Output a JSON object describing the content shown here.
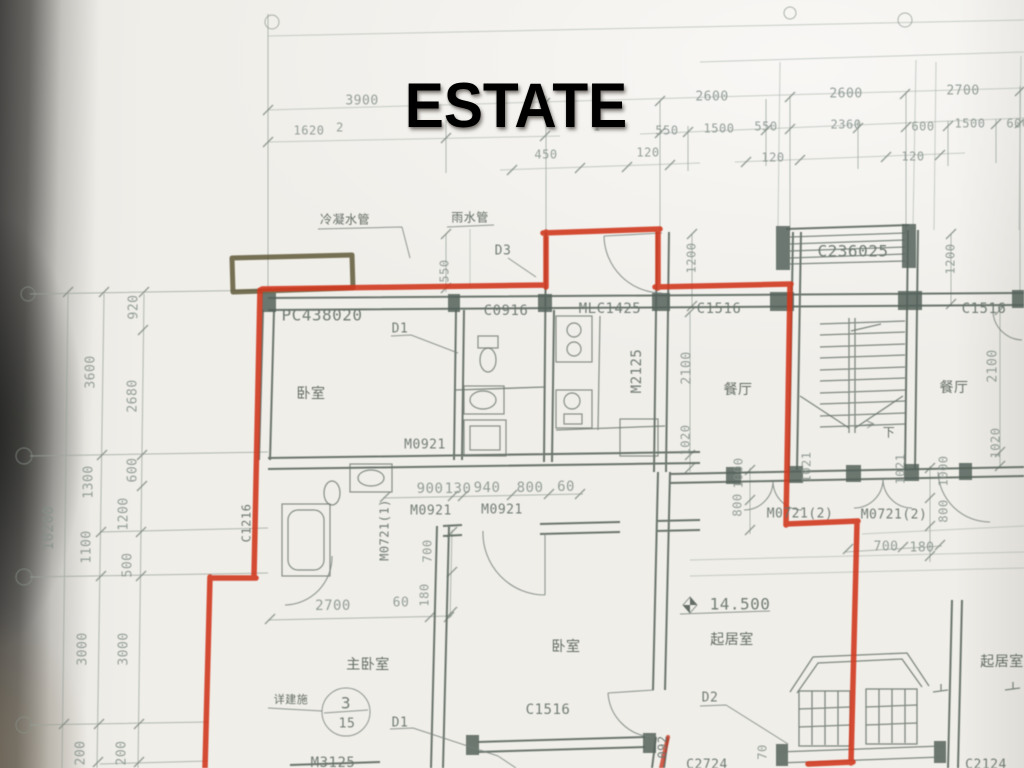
{
  "slide": {
    "title": "ESTATE",
    "title_color": "#ffffff"
  },
  "palette": {
    "paper": "#f0eee9",
    "dim_line": "#9aa49c",
    "dim_text": "#84908a",
    "cad_text": "#68736c",
    "wall": "#5c685f",
    "red_marker": "#d0381f",
    "olive_marker": "#56502e"
  },
  "plan": {
    "type": "architectural-floor-plan-photo",
    "rooms": [
      "卧室",
      "主卧室",
      "餐厅",
      "起居室"
    ],
    "elevation_marker": "14.500",
    "detail_ref": {
      "numerator": "3",
      "denominator": "15",
      "note": "详建施"
    },
    "labels": [
      {
        "n": "dim-3900",
        "t": "3900",
        "x": 362,
        "y": 101,
        "s": 13,
        "k": "dim"
      },
      {
        "n": "dim-2600-a",
        "t": "2600",
        "x": 712,
        "y": 97,
        "s": 13,
        "k": "dim"
      },
      {
        "n": "dim-2600-b",
        "t": "2600",
        "x": 846,
        "y": 94,
        "s": 13,
        "k": "dim"
      },
      {
        "n": "dim-2700-top",
        "t": "2700",
        "x": 963,
        "y": 91,
        "s": 13,
        "k": "dim"
      },
      {
        "n": "dim-1620",
        "t": "1620",
        "x": 309,
        "y": 131,
        "s": 12,
        "k": "dim"
      },
      {
        "n": "dim-partial-2",
        "t": "2",
        "x": 340,
        "y": 128,
        "s": 12,
        "k": "dim"
      },
      {
        "n": "dim-partial-1",
        "t": "1",
        "x": 597,
        "y": 127,
        "s": 12,
        "k": "dim"
      },
      {
        "n": "dim-550-a",
        "t": "550",
        "x": 667,
        "y": 131,
        "s": 12,
        "k": "dim"
      },
      {
        "n": "dim-1500-a",
        "t": "1500",
        "x": 719,
        "y": 129,
        "s": 12,
        "k": "dim"
      },
      {
        "n": "dim-550-b",
        "t": "550",
        "x": 766,
        "y": 127,
        "s": 12,
        "k": "dim"
      },
      {
        "n": "dim-2360",
        "t": "2360",
        "x": 846,
        "y": 125,
        "s": 12,
        "k": "dim"
      },
      {
        "n": "dim-600-a",
        "t": "600",
        "x": 923,
        "y": 127,
        "s": 12,
        "k": "dim"
      },
      {
        "n": "dim-1500-b",
        "t": "1500",
        "x": 970,
        "y": 124,
        "s": 12,
        "k": "dim"
      },
      {
        "n": "dim-600-b",
        "t": "600",
        "x": 1018,
        "y": 124,
        "s": 12,
        "k": "dim"
      },
      {
        "n": "dim-450",
        "t": "450",
        "x": 546,
        "y": 155,
        "s": 12,
        "k": "dim"
      },
      {
        "n": "dim-120-a",
        "t": "120",
        "x": 648,
        "y": 153,
        "s": 12,
        "k": "dim"
      },
      {
        "n": "dim-120-b",
        "t": "120",
        "x": 773,
        "y": 158,
        "s": 12,
        "k": "dim"
      },
      {
        "n": "dim-120-c",
        "t": "120",
        "x": 913,
        "y": 157,
        "s": 12,
        "k": "dim"
      },
      {
        "n": "dim-920",
        "t": "920",
        "x": 134,
        "y": 307,
        "r": -90,
        "s": 13,
        "k": "dim"
      },
      {
        "n": "dim-3600",
        "t": "3600",
        "x": 91,
        "y": 372,
        "r": -90,
        "s": 13,
        "k": "dim"
      },
      {
        "n": "dim-2680",
        "t": "2680",
        "x": 133,
        "y": 396,
        "r": -90,
        "s": 13,
        "k": "dim"
      },
      {
        "n": "dim-600-left",
        "t": "600",
        "x": 133,
        "y": 470,
        "r": -90,
        "s": 13,
        "k": "dim"
      },
      {
        "n": "dim-1300",
        "t": "1300",
        "x": 89,
        "y": 482,
        "r": -90,
        "s": 13,
        "k": "dim"
      },
      {
        "n": "dim-1200-left",
        "t": "1200",
        "x": 124,
        "y": 514,
        "r": -90,
        "s": 13,
        "k": "dim"
      },
      {
        "n": "dim-10200",
        "t": "10200",
        "x": 49,
        "y": 528,
        "r": -90,
        "s": 14,
        "k": "dim"
      },
      {
        "n": "dim-1100",
        "t": "1100",
        "x": 87,
        "y": 547,
        "r": -90,
        "s": 13,
        "k": "dim"
      },
      {
        "n": "dim-500-left",
        "t": "500",
        "x": 128,
        "y": 565,
        "r": -90,
        "s": 13,
        "k": "dim"
      },
      {
        "n": "dim-3000-a",
        "t": "3000",
        "x": 83,
        "y": 649,
        "r": -90,
        "s": 13,
        "k": "dim"
      },
      {
        "n": "dim-3000-b",
        "t": "3000",
        "x": 124,
        "y": 649,
        "r": -90,
        "s": 13,
        "k": "dim"
      },
      {
        "n": "dim-200-a",
        "t": "200",
        "x": 81,
        "y": 753,
        "r": -90,
        "s": 13,
        "k": "dim"
      },
      {
        "n": "dim-200-b",
        "t": "200",
        "x": 122,
        "y": 753,
        "r": -90,
        "s": 13,
        "k": "dim"
      },
      {
        "n": "note-cold-pipe",
        "t": "冷凝水管",
        "x": 345,
        "y": 220,
        "s": 12,
        "k": "cjk"
      },
      {
        "n": "note-rain-pipe",
        "t": "雨水管",
        "x": 470,
        "y": 218,
        "s": 12,
        "k": "cjk"
      },
      {
        "n": "label-pc438020",
        "t": "PC438020",
        "x": 322,
        "y": 316,
        "s": 16,
        "k": "cad"
      },
      {
        "n": "label-d1-top",
        "t": "D1",
        "x": 400,
        "y": 329,
        "s": 13,
        "k": "cad"
      },
      {
        "n": "label-c0916",
        "t": "C0916",
        "x": 506,
        "y": 311,
        "s": 14,
        "k": "cad"
      },
      {
        "n": "label-mlc1425",
        "t": "MLC1425",
        "x": 610,
        "y": 309,
        "s": 14,
        "k": "cad"
      },
      {
        "n": "label-c1516-top",
        "t": "C1516",
        "x": 719,
        "y": 309,
        "s": 14,
        "k": "cad"
      },
      {
        "n": "label-c236025",
        "t": "C236025",
        "x": 853,
        "y": 252,
        "s": 16,
        "k": "cad"
      },
      {
        "n": "label-c1516-topright",
        "t": "C1516",
        "x": 984,
        "y": 309,
        "s": 14,
        "k": "cad"
      },
      {
        "n": "label-d3",
        "t": "D3",
        "x": 503,
        "y": 251,
        "s": 13,
        "k": "cad"
      },
      {
        "n": "dim-550-mid",
        "t": "550",
        "x": 445,
        "y": 271,
        "r": -90,
        "s": 12,
        "k": "dim"
      },
      {
        "n": "dim-1200-mid-a",
        "t": "1200",
        "x": 692,
        "y": 258,
        "r": -90,
        "s": 12,
        "k": "dim"
      },
      {
        "n": "dim-1200-mid-b",
        "t": "1200",
        "x": 951,
        "y": 259,
        "r": -90,
        "s": 12,
        "k": "dim"
      },
      {
        "n": "room-bedroom-top",
        "t": "卧室",
        "x": 311,
        "y": 394,
        "s": 14,
        "k": "cjk"
      },
      {
        "n": "label-m2125",
        "t": "M2125",
        "x": 637,
        "y": 371,
        "r": -90,
        "s": 14,
        "k": "cad"
      },
      {
        "n": "dim-2100-mid",
        "t": "2100",
        "x": 687,
        "y": 368,
        "r": -90,
        "s": 13,
        "k": "dim"
      },
      {
        "n": "dim-1020-mid",
        "t": "1020",
        "x": 686,
        "y": 440,
        "r": -90,
        "s": 12,
        "k": "dim"
      },
      {
        "n": "room-dining-left",
        "t": "餐厅",
        "x": 738,
        "y": 390,
        "s": 14,
        "k": "cjk"
      },
      {
        "n": "room-dining-right",
        "t": "餐厅",
        "x": 954,
        "y": 388,
        "s": 14,
        "k": "cjk"
      },
      {
        "n": "dim-2100-right",
        "t": "2100",
        "x": 993,
        "y": 366,
        "r": -90,
        "s": 13,
        "k": "dim"
      },
      {
        "n": "dim-1020-right",
        "t": "1020",
        "x": 996,
        "y": 443,
        "r": -90,
        "s": 12,
        "k": "dim"
      },
      {
        "n": "label-stairs-down",
        "t": "下",
        "x": 889,
        "y": 433,
        "s": 12,
        "k": "cjk"
      },
      {
        "n": "label-m0921-top",
        "t": "M0921",
        "x": 425,
        "y": 445,
        "s": 13,
        "k": "cad"
      },
      {
        "n": "dim-900",
        "t": "900",
        "x": 430,
        "y": 489,
        "s": 14,
        "k": "dim"
      },
      {
        "n": "dim-130",
        "t": "130",
        "x": 458,
        "y": 489,
        "s": 14,
        "k": "dim"
      },
      {
        "n": "dim-940",
        "t": "940",
        "x": 487,
        "y": 488,
        "s": 14,
        "k": "dim"
      },
      {
        "n": "dim-800-mid",
        "t": "800",
        "x": 530,
        "y": 488,
        "s": 14,
        "k": "dim"
      },
      {
        "n": "dim-60-mid",
        "t": "60",
        "x": 566,
        "y": 487,
        "s": 14,
        "k": "dim"
      },
      {
        "n": "label-m0921-a",
        "t": "M0921",
        "x": 431,
        "y": 511,
        "s": 13,
        "k": "cad"
      },
      {
        "n": "label-m0921-b",
        "t": "M0921",
        "x": 502,
        "y": 510,
        "s": 13,
        "k": "cad"
      },
      {
        "n": "label-m0721-1",
        "t": "M0721(1)",
        "x": 385,
        "y": 530,
        "r": -90,
        "s": 12,
        "k": "cad"
      },
      {
        "n": "label-c1216",
        "t": "C1216",
        "x": 247,
        "y": 523,
        "r": -90,
        "s": 12,
        "k": "cad"
      },
      {
        "n": "dim-700-mid",
        "t": "700",
        "x": 428,
        "y": 551,
        "r": -90,
        "s": 12,
        "k": "dim"
      },
      {
        "n": "dim-180-mid",
        "t": "180",
        "x": 425,
        "y": 595,
        "r": -90,
        "s": 12,
        "k": "dim"
      },
      {
        "n": "dim-1000-a",
        "t": "1000",
        "x": 739,
        "y": 473,
        "r": -90,
        "s": 12,
        "k": "dim"
      },
      {
        "n": "dim-800-a",
        "t": "800",
        "x": 738,
        "y": 505,
        "r": -90,
        "s": 12,
        "k": "dim"
      },
      {
        "n": "dim-1021-a",
        "t": "1021",
        "x": 807,
        "y": 467,
        "r": -90,
        "s": 12,
        "k": "dim"
      },
      {
        "n": "dim-1021-b",
        "t": "1021",
        "x": 901,
        "y": 469,
        "r": -90,
        "s": 12,
        "k": "dim"
      },
      {
        "n": "dim-1000-b",
        "t": "1000",
        "x": 944,
        "y": 471,
        "r": -90,
        "s": 12,
        "k": "dim"
      },
      {
        "n": "dim-800-b",
        "t": "800",
        "x": 944,
        "y": 511,
        "r": -90,
        "s": 12,
        "k": "dim"
      },
      {
        "n": "label-m0721-2a",
        "t": "M0721(2)",
        "x": 800,
        "y": 514,
        "s": 13,
        "k": "cad"
      },
      {
        "n": "label-m0721-2b",
        "t": "M0721(2)",
        "x": 894,
        "y": 515,
        "s": 13,
        "k": "cad"
      },
      {
        "n": "dim-700-bot",
        "t": "700",
        "x": 886,
        "y": 547,
        "s": 13,
        "k": "dim"
      },
      {
        "n": "dim-180-bot",
        "t": "180",
        "x": 922,
        "y": 548,
        "s": 13,
        "k": "dim"
      },
      {
        "n": "dim-2700-bot",
        "t": "2700",
        "x": 333,
        "y": 606,
        "s": 14,
        "k": "dim"
      },
      {
        "n": "dim-60-bot",
        "t": "60",
        "x": 401,
        "y": 603,
        "s": 13,
        "k": "dim"
      },
      {
        "n": "room-master-bedroom",
        "t": "主卧室",
        "x": 368,
        "y": 665,
        "s": 14,
        "k": "cjk"
      },
      {
        "n": "note-detail-ref",
        "t": "详建施",
        "x": 291,
        "y": 700,
        "s": 11,
        "k": "cjk"
      },
      {
        "n": "detail-circle-num",
        "t": "3",
        "x": 346,
        "y": 704,
        "s": 16,
        "k": "cad"
      },
      {
        "n": "detail-circle-den",
        "t": "15",
        "x": 347,
        "y": 724,
        "s": 13,
        "k": "cad"
      },
      {
        "n": "label-d1-bot",
        "t": "D1",
        "x": 400,
        "y": 723,
        "s": 13,
        "k": "cad"
      },
      {
        "n": "room-bedroom-bot",
        "t": "卧室",
        "x": 566,
        "y": 647,
        "s": 14,
        "k": "cjk"
      },
      {
        "n": "label-c1516-bot",
        "t": "C1516",
        "x": 548,
        "y": 710,
        "s": 14,
        "k": "cad"
      },
      {
        "n": "label-m3125",
        "t": "M3125",
        "x": 333,
        "y": 763,
        "s": 14,
        "k": "cad"
      },
      {
        "n": "elev-value",
        "t": "14.500",
        "x": 740,
        "y": 605,
        "s": 16,
        "k": "cad"
      },
      {
        "n": "room-living",
        "t": "起居室",
        "x": 732,
        "y": 640,
        "s": 14,
        "k": "cjk"
      },
      {
        "n": "label-d2",
        "t": "D2",
        "x": 710,
        "y": 698,
        "s": 13,
        "k": "cad"
      },
      {
        "n": "room-living-right",
        "t": "起居室",
        "x": 1002,
        "y": 662,
        "s": 14,
        "k": "cjk"
      },
      {
        "n": "label-092",
        "t": "092",
        "x": 663,
        "y": 747,
        "r": -90,
        "s": 12,
        "k": "cad"
      },
      {
        "n": "dim-70",
        "t": "70",
        "x": 763,
        "y": 752,
        "r": -90,
        "s": 12,
        "k": "dim"
      },
      {
        "n": "label-c2724",
        "t": "C2724",
        "x": 707,
        "y": 765,
        "s": 13,
        "k": "cad"
      },
      {
        "n": "label-c2124",
        "t": "C2124",
        "x": 986,
        "y": 765,
        "s": 13,
        "k": "cad"
      }
    ]
  }
}
